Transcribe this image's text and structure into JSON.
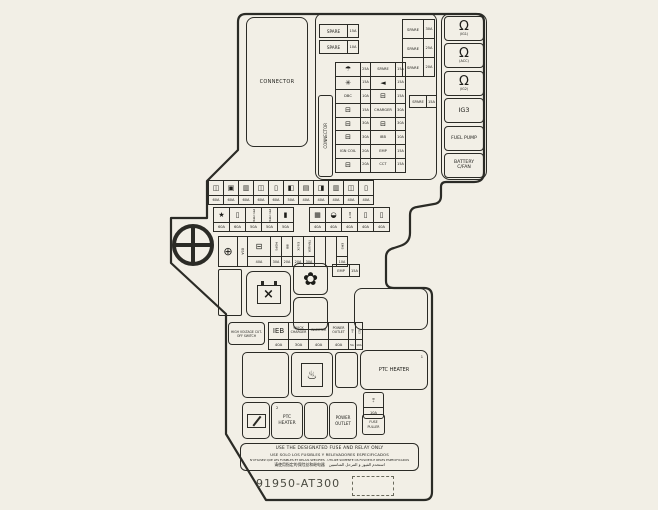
{
  "colors": {
    "background": "#f2efe6",
    "line": "#2b2b26",
    "text": "#1c1c18"
  },
  "connector_main": "CONNECTOR",
  "connector_side": "CONNECTOR",
  "top_spares_left": [
    {
      "label": "SPARE",
      "rating": "15A"
    },
    {
      "label": "SPARE",
      "rating": "10A"
    }
  ],
  "top_spares_right": [
    {
      "label": "SPARE",
      "rating": "30A"
    },
    {
      "label": "SPARE",
      "rating": "25A"
    },
    {
      "label": "SPARE",
      "rating": "20A"
    }
  ],
  "lone_spare": {
    "label": "SPARE",
    "rating": "15A"
  },
  "grid": [
    {
      "lt": "☂",
      "lc": "ic",
      "lr": "25A",
      "rt": "SPARE",
      "rr": "15A"
    },
    {
      "lt": "✳",
      "lc": "ic",
      "lr": "15A",
      "rt": "◄",
      "rc": "ic",
      "rr": "15A"
    },
    {
      "lt": "DBC",
      "lr": "10A",
      "rt": "⊟",
      "rc": "ic",
      "rr": "15A"
    },
    {
      "lt": "⊟",
      "lc": "ic",
      "lr": "15A",
      "rt": "CHARGER",
      "rr": "30A"
    },
    {
      "lt": "⊟",
      "lc": "ic",
      "lr": "30A",
      "rt": "⊟",
      "rc": "ic",
      "rr": "30A"
    },
    {
      "lt": "⊟",
      "lc": "ic",
      "lr": "30A",
      "rt": "IBB",
      "rr": "10A"
    },
    {
      "lt": "IGN COIL",
      "lr": "20A",
      "rt": "EMP",
      "rr": "15A"
    },
    {
      "lt": "⊟",
      "lc": "ic",
      "lr": "20A",
      "rt": "CCT",
      "rr": "15A"
    }
  ],
  "ig_panel": [
    {
      "glyph": "Ω",
      "label": "(IG1)"
    },
    {
      "glyph": "Ω",
      "label": "(ACC)"
    },
    {
      "glyph": "Ω",
      "label": "(IG2)"
    },
    {
      "label": "IG3",
      "cls": "one"
    },
    {
      "label": "FUEL PUMP",
      "cls": "two"
    },
    {
      "label": "BATTERY C/FAN",
      "cls": "two"
    }
  ],
  "rowA": [
    {
      "g": "◫",
      "r": "60A"
    },
    {
      "g": "▣",
      "r": "60A"
    },
    {
      "g": "▥",
      "r": "60A"
    },
    {
      "g": "◫",
      "r": "60A"
    },
    {
      "g": "▯",
      "r": "60A"
    },
    {
      "g": "◧",
      "r": "50A"
    },
    {
      "g": "▤",
      "r": "40A"
    },
    {
      "g": "◨",
      "r": "40A"
    },
    {
      "g": "▥",
      "r": "40A"
    },
    {
      "g": "◫",
      "r": "40A"
    },
    {
      "g": "▯",
      "r": "40A"
    }
  ],
  "rowB": [
    {
      "g": "★",
      "r": "60A"
    },
    {
      "g": "▯",
      "r": "60A"
    },
    {
      "t": "PTC HTR",
      "cls": "vert",
      "r": "50A"
    },
    {
      "t": "PTC HTR",
      "cls": "vert",
      "r": "50A"
    },
    {
      "g": "▮",
      "r": "50A"
    },
    {
      "cls": "gap"
    },
    {
      "g": "▦",
      "r": "40A"
    },
    {
      "g": "◒",
      "r": "40A"
    },
    {
      "t": "DCT",
      "cls": "vert",
      "r": "40A"
    },
    {
      "g": "▯",
      "r": "40A"
    },
    {
      "g": "▯",
      "r": "40A"
    }
  ],
  "rowC": [
    {
      "t": "⊕",
      "cls": "cplus",
      "r": "80A"
    },
    {
      "t": "⊟",
      "cls": "cbat",
      "r": "40A"
    },
    {
      "t": "MDPS",
      "cls": "vert2",
      "r": "30A"
    },
    {
      "t": "IBB",
      "cls": "vert2",
      "r": "20A"
    },
    {
      "t": "E/LCK",
      "cls": "vert2",
      "r": "20A"
    },
    {
      "t": "TRAILER",
      "cls": "vert2",
      "r": "30A"
    },
    {
      "cls": "blank"
    },
    {
      "cls": "blank"
    },
    {
      "t": "EMS",
      "cls": "vert2",
      "r": "10A"
    }
  ],
  "emp_fuse": {
    "label": "EMP",
    "rating": "15A"
  },
  "hv_switch_label": "HIGH VOLTAGE CUT-OFF SWITCH",
  "hv_row": [
    {
      "t": "IEB",
      "cls": "ieb",
      "r": "40A"
    },
    {
      "t": "QUICK CHARGER",
      "r": "30A"
    },
    {
      "t": "INVERTER",
      "r": "40A"
    },
    {
      "t": "POWER OUTLET",
      "r": "40A"
    },
    {
      "t": "B+",
      "cls": "nv",
      "r": "5A"
    },
    {
      "t": "IG3",
      "cls": "nv",
      "r": "10A"
    }
  ],
  "bottom": {
    "ptc1_label": "PTC HEATER",
    "ptc1_sup": "1",
    "ptc2_label": "PTC HEATER",
    "ptc2_sup": "2",
    "power_outlet": "POWER OUTLET",
    "fuse_puller": "FUSE PULLER",
    "side_fuse_label": "B+",
    "side_fuse_rating": "10A",
    "defrost_glyph": "♨",
    "fan_glyph": "✿",
    "relay_glyph": "×"
  },
  "warning": {
    "line1": "USE THE DESIGNATED FUSE AND RELAY ONLY",
    "line2": "USE SOLO LOS FUSIBLES Y RELEVADORES ESPECIFICADOS",
    "line3": "N'UTILISEZ QUE LES FUSIBLES ET RELAIS SPECIFIES · UTILIZE SOMENTE OS FUSIVEIS E RELES ESPECIFICADOS",
    "line4": "请使用指定的保险丝和继电器　استخدم الفيوز و المرحل المناسبين"
  },
  "part_number": "91950-AT300"
}
